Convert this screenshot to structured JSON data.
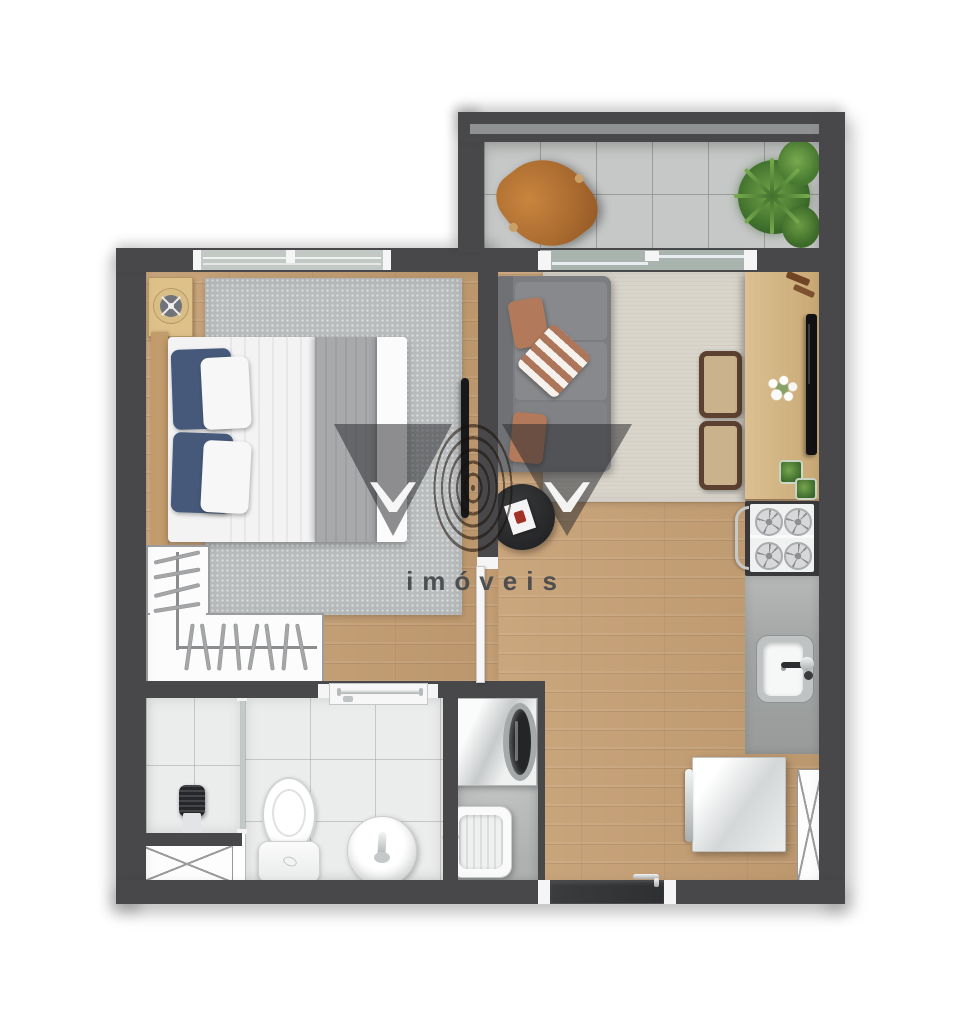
{
  "meta": {
    "type": "residential-floor-plan",
    "view": "top-down-3d-render"
  },
  "watermark": {
    "text": "imóveis",
    "logo": "two-dark-triangles-with-white-chevrons-and-fingerprint-wave-center",
    "text_color": "#515257"
  },
  "palette": {
    "wall": "#48484b",
    "wood_floor": "#c69f73",
    "balcony_tile": "#c6c8c7",
    "bathroom_tile": "#ebecec",
    "laundry_floor": "#b2b5b4",
    "bedroom_rug": "#b9bcbd",
    "living_rug": "#d9d5cb",
    "sofa_gray": "#7b7d80",
    "terracotta_pillow": "#b27a5a",
    "navy_pillow": "#46597a",
    "wood_furniture": "#d7ba88",
    "counter_gray": "#a2a5a4",
    "plant_green": "#4e7f35",
    "leather_chair": "#b5703a",
    "entry_door": "#38393b"
  },
  "rooms": [
    {
      "name": "balcony",
      "items": [
        "butterfly-chair",
        "potted-plant",
        "parapet-railing",
        "sliding-glass-door"
      ]
    },
    {
      "name": "bedroom",
      "items": [
        "double-bed",
        "navy-pillows",
        "white-pillows",
        "gray-throw",
        "headboard",
        "side-table-with-fan-decor",
        "gray-rug",
        "wall-tv",
        "window",
        "wardrobe-with-hangers",
        "pocket-door"
      ]
    },
    {
      "name": "living-dining",
      "items": [
        "gray-sofa",
        "terracotta-pillows",
        "chevron-pillow",
        "round-coffee-table",
        "magazine",
        "beige-rug",
        "sideboard-dining-counter",
        "two-chairs",
        "tv",
        "white-flowers",
        "plant-cubes",
        "decor-pieces"
      ]
    },
    {
      "name": "kitchen",
      "items": [
        "cooktop-4-burners",
        "oven-handle",
        "gray-countertop",
        "steel-sink",
        "faucet",
        "refrigerator",
        "ventilation-shaft"
      ]
    },
    {
      "name": "laundry",
      "items": [
        "washing-machine",
        "utility-tub",
        "faucet"
      ]
    },
    {
      "name": "bathroom",
      "items": [
        "shower-stall",
        "shower-column",
        "glass-partition",
        "toilet",
        "round-basin",
        "faucet",
        "door-with-towel-bar",
        "ventilation-shaft"
      ]
    },
    {
      "name": "entry",
      "items": [
        "entry-door",
        "door-handle"
      ]
    }
  ]
}
